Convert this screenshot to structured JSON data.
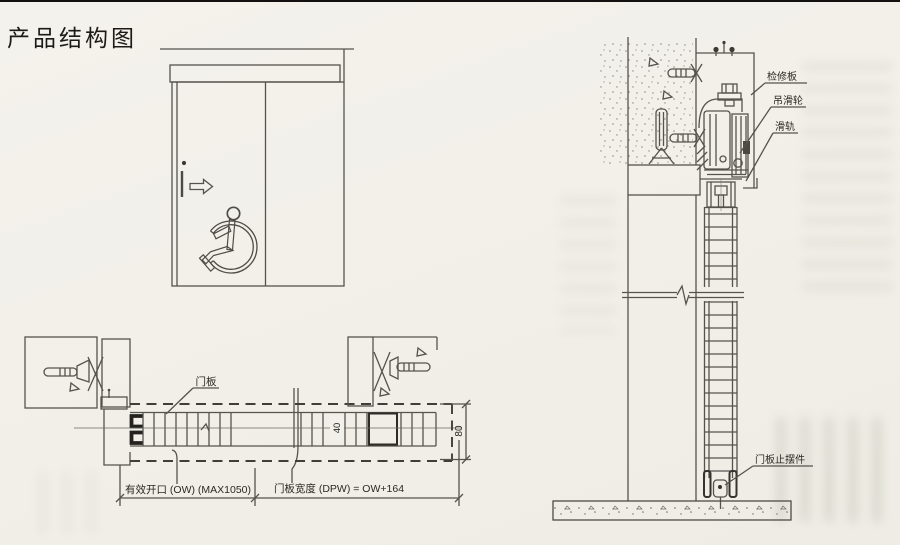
{
  "page": {
    "title": "产品结构图",
    "paper_color": "#f2f0ea",
    "ink_color": "#55534d"
  },
  "plan_view": {
    "panel_label": "门板",
    "opening_dim": "有效开口 (OW)  (MAX1050)",
    "panel_width_dim": "门板宽度 (DPW) = OW+164",
    "thickness_dim": "80",
    "rail_width_dim": "40"
  },
  "section_view": {
    "access_panel_label": "检修板",
    "hanger_roller_label": "吊滑轮",
    "rail_label": "滑轨",
    "floor_guide_label": "门板止摆件"
  }
}
